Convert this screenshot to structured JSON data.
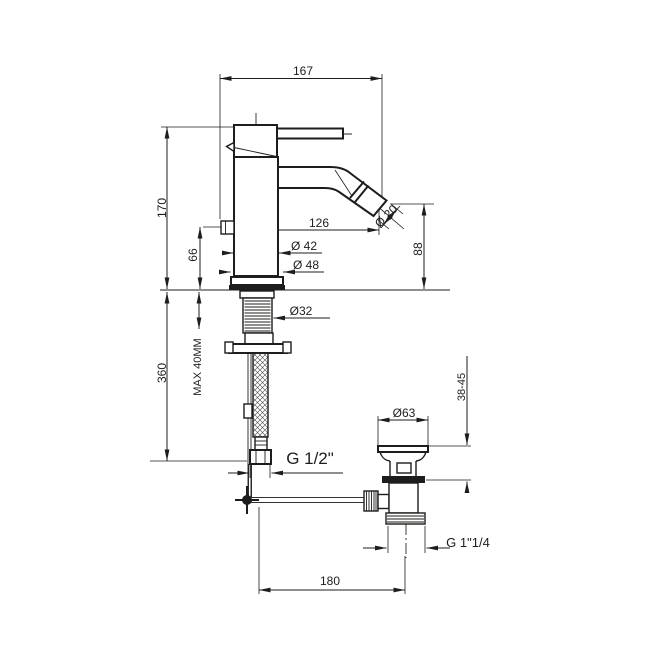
{
  "drawing": {
    "type": "technical-drawing",
    "subject": "single-lever bidet mixer tap with flexible hose and pop-up waste, side elevation with dimensions",
    "background": "#ffffff",
    "line_color": "#1d1d1b",
    "units": "mm",
    "labels": {
      "width_overall": "167",
      "height_body": "170",
      "spout_reach": "126",
      "body_dia": "Ø 42",
      "base_dia": "Ø 48",
      "outlet_height": "66",
      "aerator_dia": "Ø 20",
      "spout_height": "88",
      "shank_dia": "Ø32",
      "max_deck": "MAX 40MM",
      "hose_length": "360",
      "waste_deck_range": "38-45",
      "waste_flange_dia": "Ø63",
      "supply_thread": "G 1/2\"",
      "waste_thread": "G 1\"1/4",
      "drain_offset": "180"
    }
  }
}
